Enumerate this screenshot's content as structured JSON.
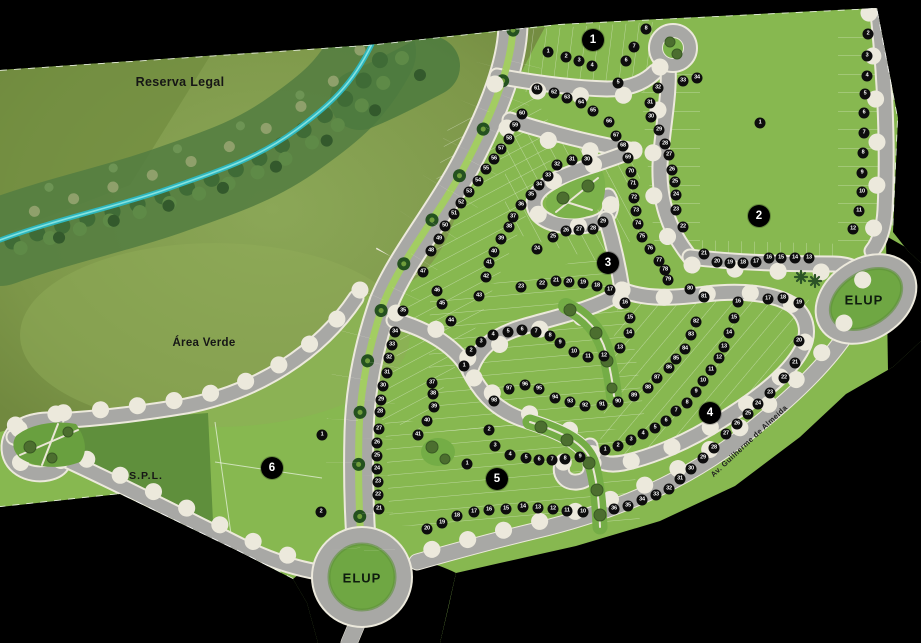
{
  "labels": {
    "reserva_legal": "Reserva Legal",
    "area_verde": "Área Verde",
    "spl": "S.P.L.",
    "elup_bottom": "ELUP",
    "elup_right": "ELUP",
    "avenue": "Av. Guilherme de Almeida"
  },
  "colors": {
    "background": "#000000",
    "lot_green": "#87b850",
    "reserve_olive": "#7d9749",
    "forest_green": "#4c7a3e",
    "stream_teal": "#3fc9cc",
    "road_gray": "#a8a8a5",
    "road_edge": "#ece9dc",
    "median_green": "#a3cd62",
    "spl_green": "#5f8f3c",
    "elup_green": "#6fa743",
    "marker_black": "#0d0d0d",
    "marker_text": "#ffffff"
  },
  "blocks": [
    {
      "n": "1",
      "x": 593,
      "y": 40
    },
    {
      "n": "2",
      "x": 759,
      "y": 216
    },
    {
      "n": "3",
      "x": 608,
      "y": 263
    },
    {
      "n": "4",
      "x": 710,
      "y": 413
    },
    {
      "n": "5",
      "x": 497,
      "y": 479
    },
    {
      "n": "6",
      "x": 272,
      "y": 468
    }
  ],
  "lots": [
    {
      "q": 1,
      "n": "1",
      "x": 548,
      "y": 52
    },
    {
      "q": 1,
      "n": "2",
      "x": 566,
      "y": 57
    },
    {
      "q": 1,
      "n": "3",
      "x": 579,
      "y": 61
    },
    {
      "q": 1,
      "n": "4",
      "x": 592,
      "y": 66
    },
    {
      "q": 1,
      "n": "5",
      "x": 618,
      "y": 83
    },
    {
      "q": 1,
      "n": "6",
      "x": 626,
      "y": 61
    },
    {
      "q": 1,
      "n": "7",
      "x": 634,
      "y": 47
    },
    {
      "q": 1,
      "n": "8",
      "x": 646,
      "y": 29
    },
    {
      "q": 2,
      "n": "1",
      "x": 760,
      "y": 123
    },
    {
      "q": 2,
      "n": "2",
      "x": 868,
      "y": 34
    },
    {
      "q": 2,
      "n": "3",
      "x": 867,
      "y": 56
    },
    {
      "q": 2,
      "n": "4",
      "x": 867,
      "y": 76
    },
    {
      "q": 2,
      "n": "5",
      "x": 865,
      "y": 94
    },
    {
      "q": 2,
      "n": "6",
      "x": 864,
      "y": 113
    },
    {
      "q": 2,
      "n": "7",
      "x": 864,
      "y": 133
    },
    {
      "q": 2,
      "n": "8",
      "x": 863,
      "y": 153
    },
    {
      "q": 2,
      "n": "9",
      "x": 862,
      "y": 173
    },
    {
      "q": 2,
      "n": "10",
      "x": 862,
      "y": 192
    },
    {
      "q": 2,
      "n": "11",
      "x": 859,
      "y": 211
    },
    {
      "q": 2,
      "n": "12",
      "x": 853,
      "y": 229
    },
    {
      "q": 2,
      "n": "13",
      "x": 809,
      "y": 258
    },
    {
      "q": 2,
      "n": "14",
      "x": 795,
      "y": 258
    },
    {
      "q": 2,
      "n": "15",
      "x": 781,
      "y": 258
    },
    {
      "q": 2,
      "n": "16",
      "x": 769,
      "y": 258
    },
    {
      "q": 2,
      "n": "17",
      "x": 756,
      "y": 262
    },
    {
      "q": 2,
      "n": "18",
      "x": 743,
      "y": 263
    },
    {
      "q": 2,
      "n": "19",
      "x": 730,
      "y": 263
    },
    {
      "q": 2,
      "n": "20",
      "x": 717,
      "y": 262
    },
    {
      "q": 2,
      "n": "21",
      "x": 704,
      "y": 254
    },
    {
      "q": 2,
      "n": "22",
      "x": 683,
      "y": 227
    },
    {
      "q": 2,
      "n": "23",
      "x": 676,
      "y": 210
    },
    {
      "q": 2,
      "n": "24",
      "x": 676,
      "y": 195
    },
    {
      "q": 2,
      "n": "25",
      "x": 675,
      "y": 182
    },
    {
      "q": 2,
      "n": "26",
      "x": 672,
      "y": 170
    },
    {
      "q": 2,
      "n": "27",
      "x": 669,
      "y": 155
    },
    {
      "q": 2,
      "n": "28",
      "x": 665,
      "y": 144
    },
    {
      "q": 2,
      "n": "29",
      "x": 659,
      "y": 130
    },
    {
      "q": 2,
      "n": "30",
      "x": 651,
      "y": 117
    },
    {
      "q": 2,
      "n": "31",
      "x": 650,
      "y": 103
    },
    {
      "q": 2,
      "n": "32",
      "x": 658,
      "y": 88
    },
    {
      "q": 2,
      "n": "33",
      "x": 683,
      "y": 81
    },
    {
      "q": 2,
      "n": "34",
      "x": 697,
      "y": 78
    },
    {
      "q": 3,
      "n": "1",
      "x": 464,
      "y": 366
    },
    {
      "q": 3,
      "n": "2",
      "x": 471,
      "y": 351
    },
    {
      "q": 3,
      "n": "3",
      "x": 481,
      "y": 342
    },
    {
      "q": 3,
      "n": "4",
      "x": 493,
      "y": 335
    },
    {
      "q": 3,
      "n": "5",
      "x": 508,
      "y": 332
    },
    {
      "q": 3,
      "n": "6",
      "x": 522,
      "y": 330
    },
    {
      "q": 3,
      "n": "7",
      "x": 536,
      "y": 332
    },
    {
      "q": 3,
      "n": "8",
      "x": 550,
      "y": 336
    },
    {
      "q": 3,
      "n": "9",
      "x": 560,
      "y": 343
    },
    {
      "q": 3,
      "n": "10",
      "x": 574,
      "y": 352
    },
    {
      "q": 3,
      "n": "11",
      "x": 588,
      "y": 357
    },
    {
      "q": 3,
      "n": "12",
      "x": 604,
      "y": 356
    },
    {
      "q": 3,
      "n": "13",
      "x": 620,
      "y": 348
    },
    {
      "q": 3,
      "n": "14",
      "x": 629,
      "y": 333
    },
    {
      "q": 3,
      "n": "15",
      "x": 630,
      "y": 318
    },
    {
      "q": 3,
      "n": "16",
      "x": 625,
      "y": 303
    },
    {
      "q": 3,
      "n": "17",
      "x": 610,
      "y": 290
    },
    {
      "q": 3,
      "n": "18",
      "x": 597,
      "y": 286
    },
    {
      "q": 3,
      "n": "19",
      "x": 583,
      "y": 283
    },
    {
      "q": 3,
      "n": "20",
      "x": 569,
      "y": 282
    },
    {
      "q": 3,
      "n": "21",
      "x": 556,
      "y": 281
    },
    {
      "q": 3,
      "n": "22",
      "x": 542,
      "y": 284
    },
    {
      "q": 3,
      "n": "23",
      "x": 521,
      "y": 287
    },
    {
      "q": 3,
      "n": "24",
      "x": 537,
      "y": 249
    },
    {
      "q": 3,
      "n": "25",
      "x": 553,
      "y": 237
    },
    {
      "q": 3,
      "n": "26",
      "x": 566,
      "y": 231
    },
    {
      "q": 3,
      "n": "27",
      "x": 579,
      "y": 230
    },
    {
      "q": 3,
      "n": "28",
      "x": 593,
      "y": 229
    },
    {
      "q": 3,
      "n": "29",
      "x": 603,
      "y": 222
    },
    {
      "q": 3,
      "n": "30",
      "x": 587,
      "y": 160
    },
    {
      "q": 3,
      "n": "31",
      "x": 572,
      "y": 160
    },
    {
      "q": 3,
      "n": "32",
      "x": 557,
      "y": 165
    },
    {
      "q": 3,
      "n": "33",
      "x": 548,
      "y": 176
    },
    {
      "q": 3,
      "n": "34",
      "x": 539,
      "y": 185
    },
    {
      "q": 3,
      "n": "35",
      "x": 531,
      "y": 195
    },
    {
      "q": 3,
      "n": "36",
      "x": 521,
      "y": 205
    },
    {
      "q": 3,
      "n": "37",
      "x": 513,
      "y": 217
    },
    {
      "q": 3,
      "n": "38",
      "x": 509,
      "y": 227
    },
    {
      "q": 3,
      "n": "39",
      "x": 501,
      "y": 239
    },
    {
      "q": 3,
      "n": "40",
      "x": 494,
      "y": 252
    },
    {
      "q": 3,
      "n": "41",
      "x": 489,
      "y": 263
    },
    {
      "q": 3,
      "n": "42",
      "x": 486,
      "y": 277
    },
    {
      "q": 3,
      "n": "43",
      "x": 479,
      "y": 296
    },
    {
      "q": 3,
      "n": "44",
      "x": 451,
      "y": 321
    },
    {
      "q": 3,
      "n": "45",
      "x": 442,
      "y": 304
    },
    {
      "q": 3,
      "n": "46",
      "x": 437,
      "y": 291
    },
    {
      "q": 3,
      "n": "47",
      "x": 423,
      "y": 272
    },
    {
      "q": 3,
      "n": "48",
      "x": 431,
      "y": 251
    },
    {
      "q": 3,
      "n": "49",
      "x": 439,
      "y": 239
    },
    {
      "q": 3,
      "n": "50",
      "x": 445,
      "y": 226
    },
    {
      "q": 3,
      "n": "51",
      "x": 454,
      "y": 214
    },
    {
      "q": 3,
      "n": "52",
      "x": 461,
      "y": 203
    },
    {
      "q": 3,
      "n": "53",
      "x": 469,
      "y": 192
    },
    {
      "q": 3,
      "n": "54",
      "x": 478,
      "y": 181
    },
    {
      "q": 3,
      "n": "55",
      "x": 486,
      "y": 169
    },
    {
      "q": 3,
      "n": "56",
      "x": 494,
      "y": 159
    },
    {
      "q": 3,
      "n": "57",
      "x": 501,
      "y": 149
    },
    {
      "q": 3,
      "n": "58",
      "x": 509,
      "y": 139
    },
    {
      "q": 3,
      "n": "59",
      "x": 515,
      "y": 126
    },
    {
      "q": 3,
      "n": "60",
      "x": 522,
      "y": 114
    },
    {
      "q": 3,
      "n": "61",
      "x": 537,
      "y": 89
    },
    {
      "q": 3,
      "n": "62",
      "x": 554,
      "y": 93
    },
    {
      "q": 3,
      "n": "63",
      "x": 567,
      "y": 98
    },
    {
      "q": 3,
      "n": "64",
      "x": 581,
      "y": 103
    },
    {
      "q": 3,
      "n": "65",
      "x": 593,
      "y": 111
    },
    {
      "q": 3,
      "n": "66",
      "x": 609,
      "y": 122
    },
    {
      "q": 3,
      "n": "67",
      "x": 616,
      "y": 136
    },
    {
      "q": 3,
      "n": "68",
      "x": 623,
      "y": 146
    },
    {
      "q": 3,
      "n": "69",
      "x": 628,
      "y": 158
    },
    {
      "q": 3,
      "n": "70",
      "x": 631,
      "y": 172
    },
    {
      "q": 3,
      "n": "71",
      "x": 633,
      "y": 184
    },
    {
      "q": 3,
      "n": "72",
      "x": 634,
      "y": 198
    },
    {
      "q": 3,
      "n": "73",
      "x": 636,
      "y": 211
    },
    {
      "q": 3,
      "n": "74",
      "x": 638,
      "y": 224
    },
    {
      "q": 3,
      "n": "75",
      "x": 642,
      "y": 237
    },
    {
      "q": 3,
      "n": "76",
      "x": 650,
      "y": 249
    },
    {
      "q": 3,
      "n": "77",
      "x": 659,
      "y": 261
    },
    {
      "q": 3,
      "n": "78",
      "x": 665,
      "y": 270
    },
    {
      "q": 3,
      "n": "79",
      "x": 668,
      "y": 280
    },
    {
      "q": 3,
      "n": "80",
      "x": 690,
      "y": 289
    },
    {
      "q": 3,
      "n": "81",
      "x": 704,
      "y": 297
    },
    {
      "q": 3,
      "n": "82",
      "x": 696,
      "y": 322
    },
    {
      "q": 3,
      "n": "83",
      "x": 691,
      "y": 335
    },
    {
      "q": 3,
      "n": "84",
      "x": 685,
      "y": 349
    },
    {
      "q": 3,
      "n": "85",
      "x": 676,
      "y": 359
    },
    {
      "q": 3,
      "n": "86",
      "x": 669,
      "y": 368
    },
    {
      "q": 3,
      "n": "87",
      "x": 657,
      "y": 378
    },
    {
      "q": 3,
      "n": "88",
      "x": 648,
      "y": 388
    },
    {
      "q": 3,
      "n": "89",
      "x": 634,
      "y": 396
    },
    {
      "q": 4,
      "n": "1",
      "x": 605,
      "y": 450
    },
    {
      "q": 4,
      "n": "2",
      "x": 618,
      "y": 446
    },
    {
      "q": 4,
      "n": "3",
      "x": 631,
      "y": 440
    },
    {
      "q": 4,
      "n": "4",
      "x": 643,
      "y": 434
    },
    {
      "q": 4,
      "n": "5",
      "x": 655,
      "y": 428
    },
    {
      "q": 4,
      "n": "6",
      "x": 666,
      "y": 421
    },
    {
      "q": 4,
      "n": "7",
      "x": 676,
      "y": 411
    },
    {
      "q": 4,
      "n": "8",
      "x": 687,
      "y": 403
    },
    {
      "q": 4,
      "n": "9",
      "x": 696,
      "y": 392
    },
    {
      "q": 4,
      "n": "10",
      "x": 703,
      "y": 381
    },
    {
      "q": 4,
      "n": "11",
      "x": 711,
      "y": 370
    },
    {
      "q": 4,
      "n": "12",
      "x": 719,
      "y": 358
    },
    {
      "q": 4,
      "n": "13",
      "x": 724,
      "y": 347
    },
    {
      "q": 4,
      "n": "14",
      "x": 729,
      "y": 333
    },
    {
      "q": 4,
      "n": "15",
      "x": 734,
      "y": 318
    },
    {
      "q": 4,
      "n": "16",
      "x": 738,
      "y": 302
    },
    {
      "q": 4,
      "n": "17",
      "x": 768,
      "y": 299
    },
    {
      "q": 4,
      "n": "18",
      "x": 783,
      "y": 298
    },
    {
      "q": 4,
      "n": "19",
      "x": 799,
      "y": 303
    },
    {
      "q": 4,
      "n": "20",
      "x": 799,
      "y": 341
    },
    {
      "q": 4,
      "n": "21",
      "x": 795,
      "y": 363
    },
    {
      "q": 4,
      "n": "22",
      "x": 784,
      "y": 378
    },
    {
      "q": 4,
      "n": "23",
      "x": 770,
      "y": 393
    },
    {
      "q": 4,
      "n": "24",
      "x": 758,
      "y": 404
    },
    {
      "q": 4,
      "n": "25",
      "x": 748,
      "y": 414
    },
    {
      "q": 4,
      "n": "26",
      "x": 737,
      "y": 424
    },
    {
      "q": 4,
      "n": "27",
      "x": 726,
      "y": 434
    },
    {
      "q": 4,
      "n": "28",
      "x": 714,
      "y": 448
    },
    {
      "q": 4,
      "n": "29",
      "x": 703,
      "y": 458
    },
    {
      "q": 4,
      "n": "30",
      "x": 691,
      "y": 469
    },
    {
      "q": 4,
      "n": "31",
      "x": 680,
      "y": 479
    },
    {
      "q": 4,
      "n": "32",
      "x": 669,
      "y": 489
    },
    {
      "q": 4,
      "n": "33",
      "x": 656,
      "y": 495
    },
    {
      "q": 4,
      "n": "34",
      "x": 642,
      "y": 500
    },
    {
      "q": 4,
      "n": "35",
      "x": 628,
      "y": 506
    },
    {
      "q": 4,
      "n": "36",
      "x": 614,
      "y": 509
    },
    {
      "q": 5,
      "n": "90",
      "x": 618,
      "y": 402
    },
    {
      "q": 5,
      "n": "91",
      "x": 602,
      "y": 405
    },
    {
      "q": 5,
      "n": "92",
      "x": 585,
      "y": 406
    },
    {
      "q": 5,
      "n": "93",
      "x": 570,
      "y": 402
    },
    {
      "q": 5,
      "n": "94",
      "x": 555,
      "y": 398
    },
    {
      "q": 5,
      "n": "95",
      "x": 539,
      "y": 389
    },
    {
      "q": 5,
      "n": "96",
      "x": 525,
      "y": 385
    },
    {
      "q": 5,
      "n": "97",
      "x": 509,
      "y": 389
    },
    {
      "q": 5,
      "n": "98",
      "x": 494,
      "y": 401
    },
    {
      "q": 5,
      "n": "1",
      "x": 467,
      "y": 464
    },
    {
      "q": 5,
      "n": "2",
      "x": 489,
      "y": 430
    },
    {
      "q": 5,
      "n": "3",
      "x": 495,
      "y": 446
    },
    {
      "q": 5,
      "n": "4",
      "x": 510,
      "y": 455
    },
    {
      "q": 5,
      "n": "5",
      "x": 526,
      "y": 458
    },
    {
      "q": 5,
      "n": "6",
      "x": 539,
      "y": 460
    },
    {
      "q": 5,
      "n": "7",
      "x": 552,
      "y": 460
    },
    {
      "q": 5,
      "n": "8",
      "x": 565,
      "y": 459
    },
    {
      "q": 5,
      "n": "9",
      "x": 580,
      "y": 457
    },
    {
      "q": 5,
      "n": "10",
      "x": 583,
      "y": 512
    },
    {
      "q": 5,
      "n": "11",
      "x": 567,
      "y": 511
    },
    {
      "q": 5,
      "n": "12",
      "x": 553,
      "y": 509
    },
    {
      "q": 5,
      "n": "13",
      "x": 538,
      "y": 508
    },
    {
      "q": 5,
      "n": "14",
      "x": 523,
      "y": 507
    },
    {
      "q": 5,
      "n": "15",
      "x": 506,
      "y": 509
    },
    {
      "q": 5,
      "n": "16",
      "x": 489,
      "y": 510
    },
    {
      "q": 5,
      "n": "17",
      "x": 474,
      "y": 512
    },
    {
      "q": 5,
      "n": "18",
      "x": 457,
      "y": 516
    },
    {
      "q": 5,
      "n": "19",
      "x": 442,
      "y": 523
    },
    {
      "q": 5,
      "n": "20",
      "x": 427,
      "y": 529
    },
    {
      "q": 5,
      "n": "21",
      "x": 379,
      "y": 509
    },
    {
      "q": 5,
      "n": "22",
      "x": 378,
      "y": 495
    },
    {
      "q": 5,
      "n": "23",
      "x": 378,
      "y": 482
    },
    {
      "q": 5,
      "n": "24",
      "x": 377,
      "y": 469
    },
    {
      "q": 5,
      "n": "25",
      "x": 377,
      "y": 456
    },
    {
      "q": 5,
      "n": "26",
      "x": 377,
      "y": 443
    },
    {
      "q": 5,
      "n": "27",
      "x": 379,
      "y": 429
    },
    {
      "q": 5,
      "n": "28",
      "x": 380,
      "y": 412
    },
    {
      "q": 5,
      "n": "29",
      "x": 381,
      "y": 400
    },
    {
      "q": 5,
      "n": "30",
      "x": 383,
      "y": 386
    },
    {
      "q": 5,
      "n": "31",
      "x": 387,
      "y": 373
    },
    {
      "q": 5,
      "n": "32",
      "x": 389,
      "y": 358
    },
    {
      "q": 5,
      "n": "33",
      "x": 392,
      "y": 345
    },
    {
      "q": 5,
      "n": "34",
      "x": 395,
      "y": 332
    },
    {
      "q": 5,
      "n": "35",
      "x": 403,
      "y": 311
    },
    {
      "q": 5,
      "n": "37",
      "x": 432,
      "y": 383
    },
    {
      "q": 5,
      "n": "38",
      "x": 433,
      "y": 394
    },
    {
      "q": 5,
      "n": "39",
      "x": 434,
      "y": 407
    },
    {
      "q": 5,
      "n": "40",
      "x": 427,
      "y": 421
    },
    {
      "q": 5,
      "n": "41",
      "x": 418,
      "y": 435
    },
    {
      "q": 6,
      "n": "1",
      "x": 322,
      "y": 435
    },
    {
      "q": 6,
      "n": "2",
      "x": 321,
      "y": 512
    }
  ]
}
